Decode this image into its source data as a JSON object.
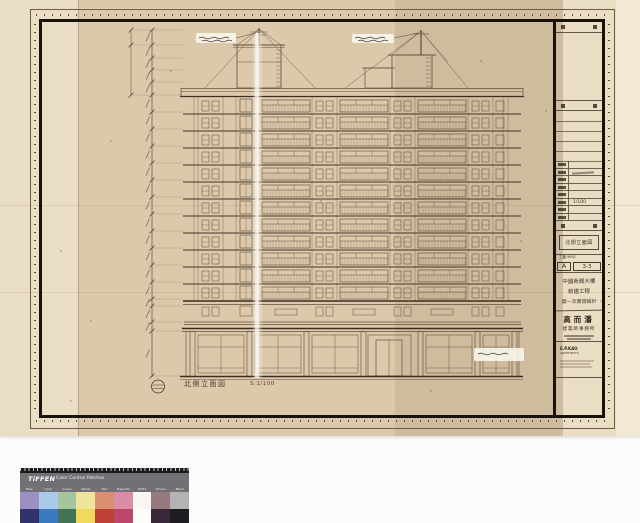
{
  "scan": {
    "background": "#fcfcfa"
  },
  "sheet": {
    "paper_color": "#e9ddc4",
    "tracing_color": "#d3bd9b",
    "ink_color": "#64503e",
    "ink_heavy": "#3a2d22"
  },
  "title_block": {
    "drawing_title": "北側立面図",
    "job_line": "工番 9601",
    "rev_letter": "A",
    "sheet_no": "3-3",
    "scale_value": "1/100",
    "project_line1": "中國新聞大樓",
    "project_line2": "新建工程",
    "project_line3": "第一次實施設計",
    "firm_name": "高而潘",
    "firm_suffix": "建築師事務所",
    "firm_latin1": "E.P.KAO",
    "firm_latin2": "ARCHITECTS"
  },
  "drawing": {
    "label": "北側立面図",
    "scale_note": "S:1/100",
    "floors": 12
  },
  "color_card": {
    "brand": "TiFFEN",
    "title": "Color Control Patches",
    "labels": [
      "Blue",
      "Cyan",
      "Green",
      "Yellow",
      "Red",
      "Magenta",
      "White",
      "3/Color",
      "Black"
    ],
    "row1": [
      "#9b90c1",
      "#a9cbe7",
      "#a5c4a0",
      "#efe49c",
      "#da9070",
      "#d98da6",
      "#f7f6f2",
      "#977a80",
      "#b3b2b4"
    ],
    "row2": [
      "#33336c",
      "#3c79c3",
      "#427354",
      "#f0da5e",
      "#bd4134",
      "#bc476b",
      "#fcfcfa",
      "#392837",
      "#1d1c21"
    ]
  }
}
